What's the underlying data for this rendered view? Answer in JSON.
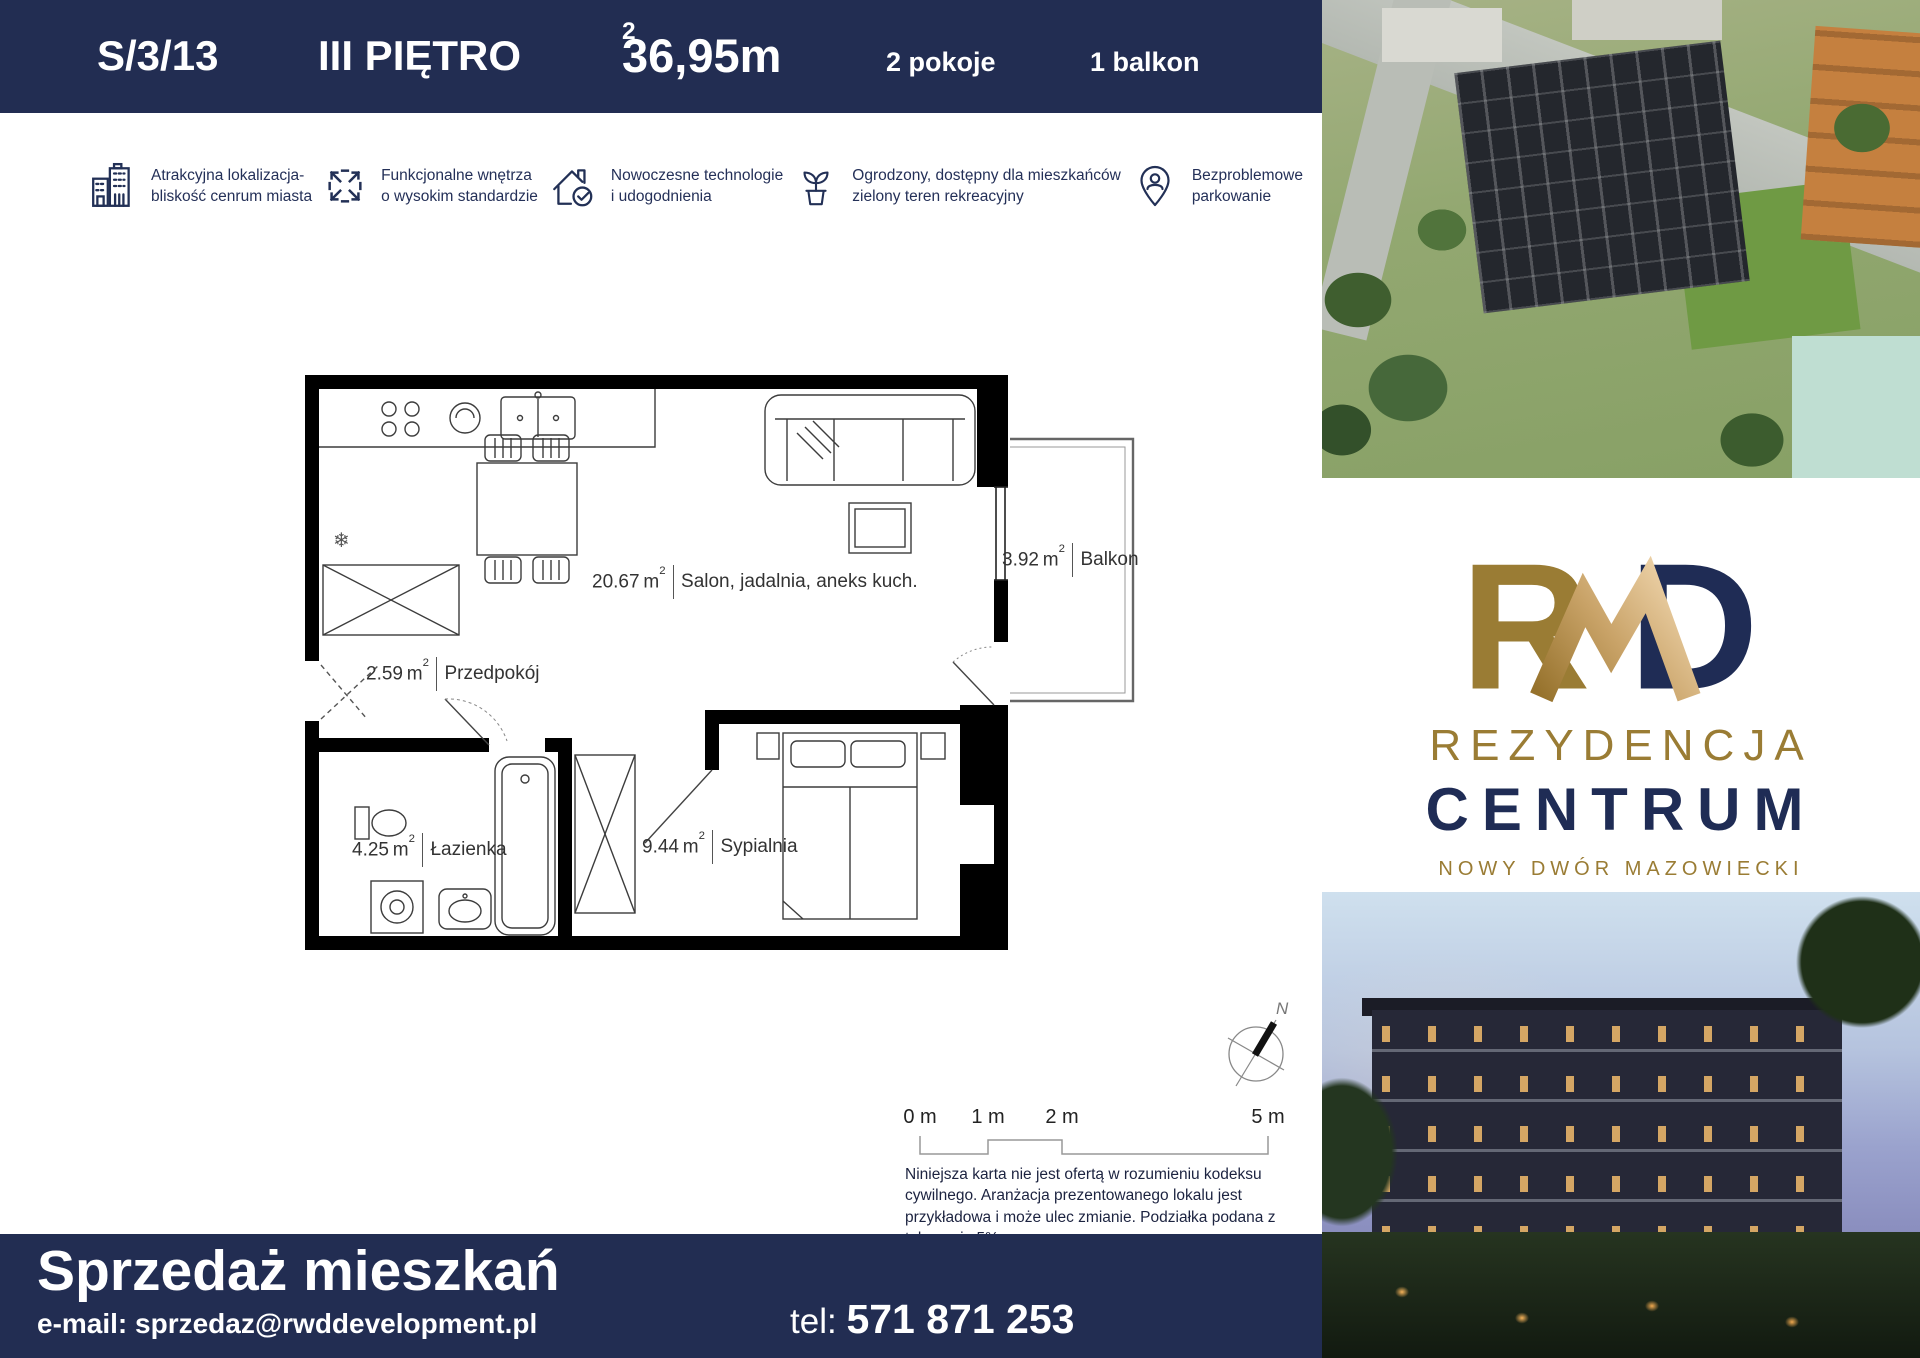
{
  "colors": {
    "navy": "#222d52",
    "gold": "#9a7c34",
    "gold_light": "#eccfa5",
    "wall_black": "#000000"
  },
  "header": {
    "unit_id": "S/3/13",
    "floor": "III PIĘTRO",
    "area": "36,95m",
    "area_sup": "2",
    "rooms": "2 pokoje",
    "balcony": "1 balkon"
  },
  "features": [
    {
      "icon": "city-buildings-icon",
      "line1": "Atrakcyjna lokalizacja-",
      "line2": "bliskość cenrum miasta"
    },
    {
      "icon": "expand-arrows-icon",
      "line1": "Funkcjonalne wnętrza",
      "line2": "o wysokim standardzie"
    },
    {
      "icon": "house-check-icon",
      "line1": "Nowoczesne technologie",
      "line2": "i udogodnienia"
    },
    {
      "icon": "plant-pot-icon",
      "line1": "Ogrodzony, dostępny dla mieszkańców",
      "line2": "zielony teren rekreacyjny"
    },
    {
      "icon": "parking-pin-icon",
      "line1": "Bezproblemowe",
      "line2": "parkowanie"
    }
  ],
  "floor_plan": {
    "rooms": [
      {
        "area": "20.67",
        "unit": "m",
        "sup": "2",
        "name": "Salon, jadalnia, aneks kuch."
      },
      {
        "area": "2.59",
        "unit": "m",
        "sup": "2",
        "name": "Przedpokój"
      },
      {
        "area": "4.25",
        "unit": "m",
        "sup": "2",
        "name": "Łazienka"
      },
      {
        "area": "9.44",
        "unit": "m",
        "sup": "2",
        "name": "Sypialnia"
      },
      {
        "area": "3.92",
        "unit": "m",
        "sup": "2",
        "name": "Balkon"
      }
    ],
    "compass_label": "N",
    "scale_labels": [
      "0 m",
      "1 m",
      "2 m",
      "5 m"
    ],
    "disclaimer": "Niniejsza karta nie jest ofertą w rozumieniu kodeksu cywilnego. Aranżacja prezentowanego lokalu jest przykładowa i może ulec zmianie. Podziałka podana z tolerancją 5%."
  },
  "brand": {
    "monogram_r": "R",
    "monogram_d": "D",
    "name_line1": "REZYDENCJA",
    "name_line2": "CENTRUM",
    "city": "NOWY DWÓR MAZOWIECKI"
  },
  "footer": {
    "title": "Sprzedaż mieszkań",
    "email": "e-mail: sprzedaz@rwddevelopment.pl",
    "tel_label": "tel:",
    "tel_number": "571 871 253"
  }
}
